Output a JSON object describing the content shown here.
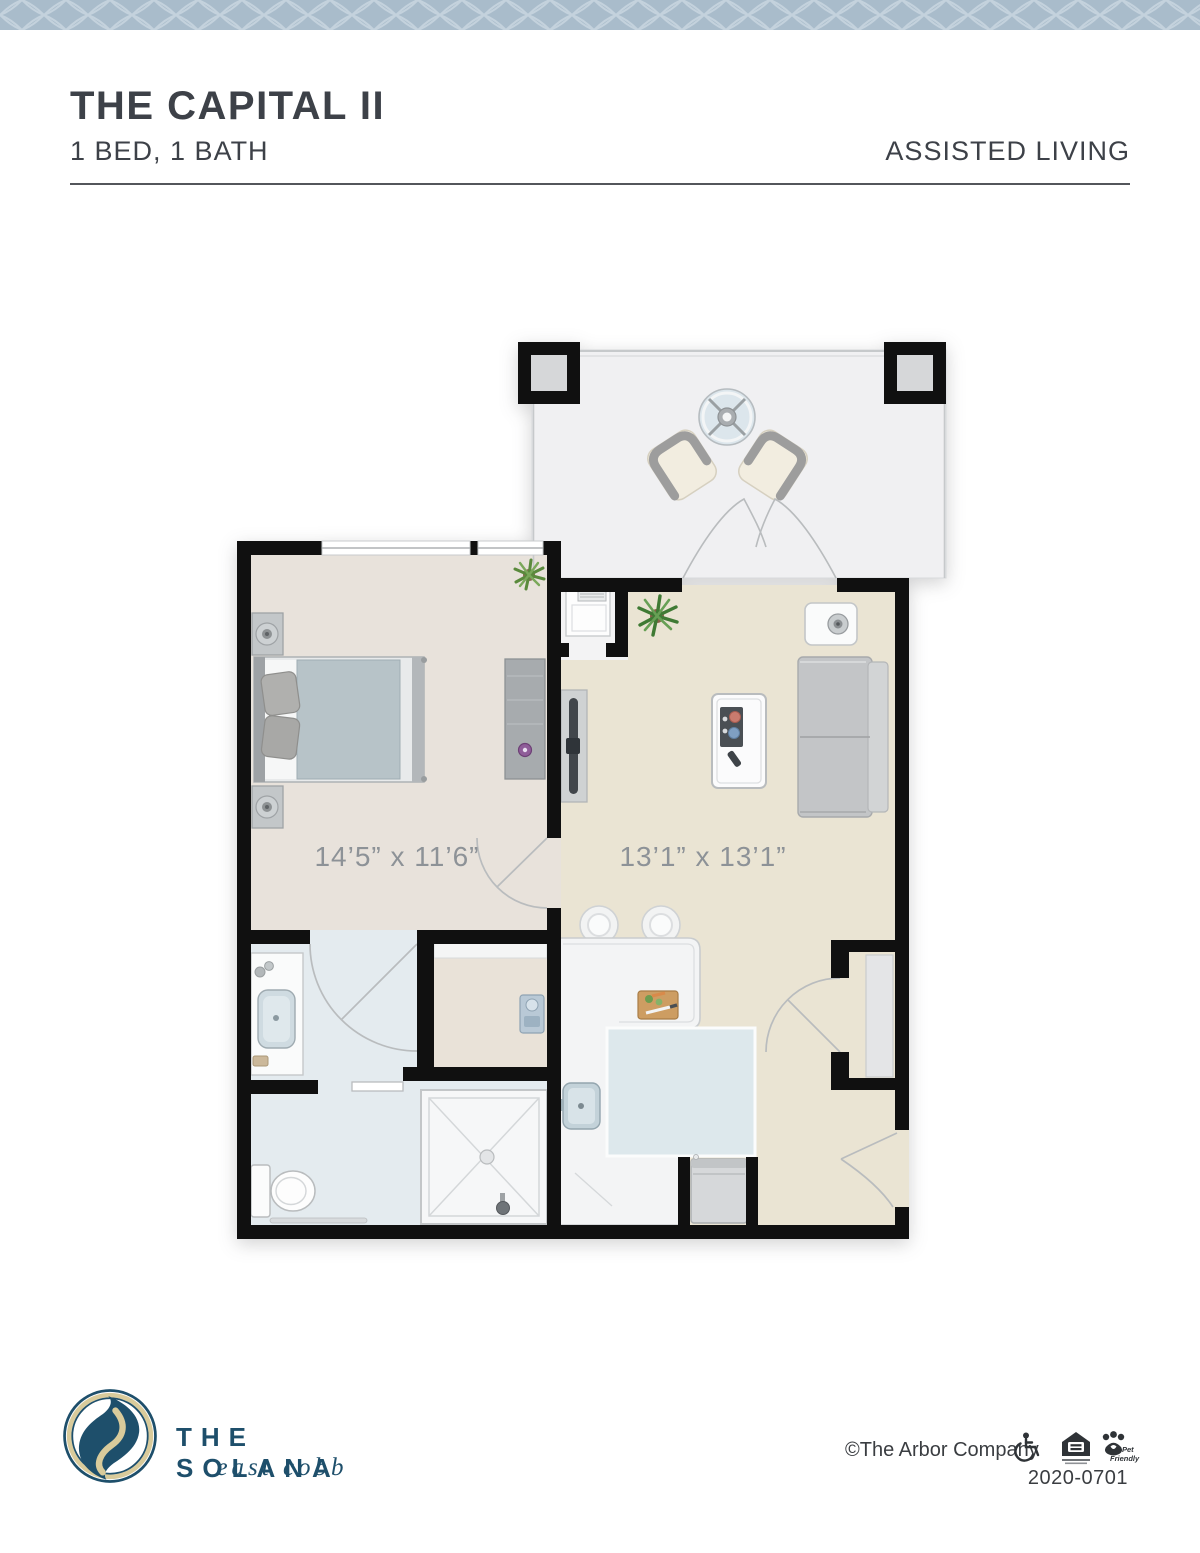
{
  "header": {
    "title": "THE CAPITAL II",
    "subtitle": "1 BED, 1 BATH",
    "category": "ASSISTED LIVING"
  },
  "floorplan": {
    "rooms": [
      {
        "name": "bedroom",
        "dimensions": "14’5” x 11’6”"
      },
      {
        "name": "living room",
        "dimensions": "13’1” x 13’1”"
      }
    ],
    "areas": [
      "patio",
      "bedroom",
      "living room",
      "kitchen",
      "bathroom",
      "closet",
      "entry"
    ]
  },
  "footer": {
    "logo": {
      "name": "THE SOLANA",
      "location": "east cobb"
    },
    "copyright": "©The Arbor Company",
    "document_number": "2020-0701",
    "badges": {
      "wheelchair": "wheelchair-accessible",
      "equal_housing": "equal-housing-opportunity",
      "pet_line1": "Pet",
      "pet_line2": "Friendly"
    }
  },
  "colors": {
    "band_bg": "#a9bccb",
    "band_line": "#c4d2dd",
    "text_dark": "#3d4148",
    "dim_text": "#8d9297",
    "wall": "#101010",
    "bedroom_floor": "#e8e2db",
    "living_floor": "#eae4d3",
    "bath_floor": "#e4ebef",
    "kitchen_floor": "#dde8ec",
    "counter": "#f3f4f5",
    "patio_floor": "#f0f0f2",
    "accent_teal": "#1e4f6b",
    "accent_cream": "#d9cb9b"
  }
}
